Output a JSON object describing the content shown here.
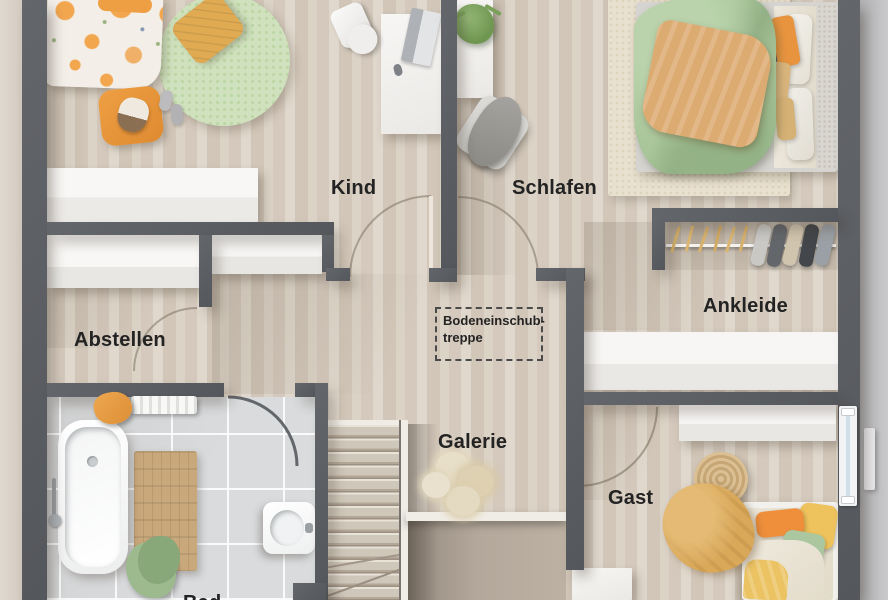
{
  "labels": {
    "kind": "Kind",
    "schlafen": "Schlafen",
    "abstellen": "Abstellen",
    "ankleide": "Ankleide",
    "galerie": "Galerie",
    "gast": "Gast",
    "bad": "Bad",
    "attic_line1": "Bodeneinschub-",
    "attic_line2": "treppe"
  },
  "colors": {
    "wall": "#5a5e63",
    "floor_wood": "#d8cec2",
    "floor_tile": "#d9dbdd",
    "exterior": "#bfbfc1",
    "rug_green": "#d0e2bd",
    "rug_cream": "#e9e1cf",
    "duvet_green": "#a9c69b",
    "accent_orange": "#ef9f43",
    "accent_mustard": "#dfaa52",
    "wood_mat": "#c9a87c",
    "stair_wood": "#cbc3b6",
    "railing_white": "#f0ede7",
    "window_glass": "#cfe0ea",
    "label_text": "#232323"
  }
}
